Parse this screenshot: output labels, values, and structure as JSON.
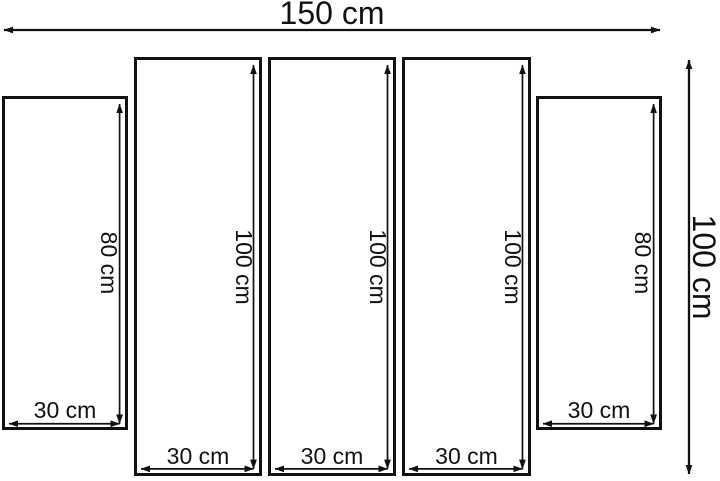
{
  "diagram": {
    "overall": {
      "width_label": "150 cm",
      "height_label": "100 cm"
    },
    "panels": [
      {
        "height_label": "80 cm",
        "width_label": "30 cm"
      },
      {
        "height_label": "100 cm",
        "width_label": "30 cm"
      },
      {
        "height_label": "100 cm",
        "width_label": "30 cm"
      },
      {
        "height_label": "100 cm",
        "width_label": "30 cm"
      },
      {
        "height_label": "80 cm",
        "width_label": "30 cm"
      }
    ],
    "colors": {
      "line": "#111111",
      "background": "#ffffff"
    }
  }
}
